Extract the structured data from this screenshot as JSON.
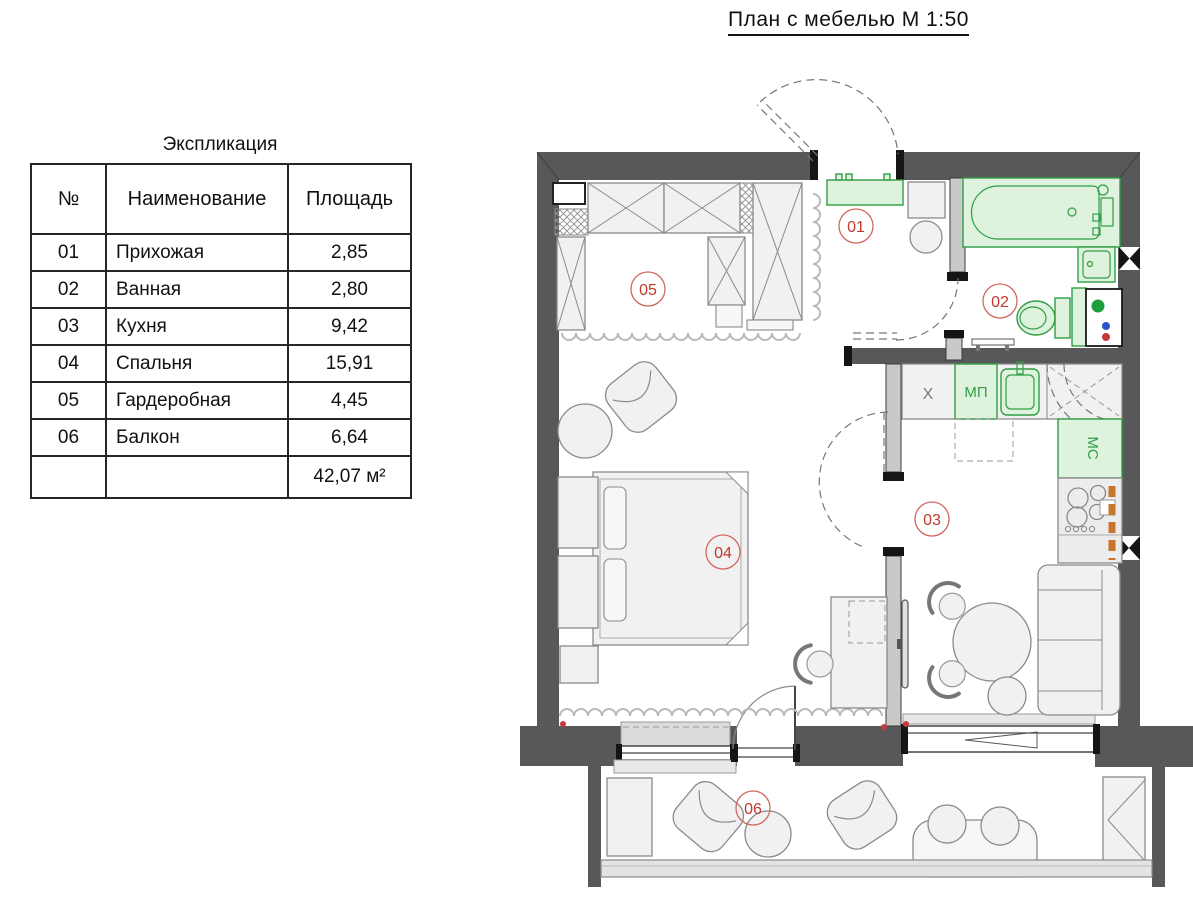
{
  "page_title": "План с мебелью М 1:50",
  "legend": {
    "title": "Экспликация",
    "columns": {
      "num": "№",
      "name": "Наименование",
      "area": "Площадь"
    },
    "rows": [
      {
        "num": "01",
        "name": "Прихожая",
        "area": "2,85"
      },
      {
        "num": "02",
        "name": "Ванная",
        "area": "2,80"
      },
      {
        "num": "03",
        "name": "Кухня",
        "area": "9,42"
      },
      {
        "num": "04",
        "name": "Спальня",
        "area": "15,91"
      },
      {
        "num": "05",
        "name": "Гардеробная",
        "area": "4,45"
      },
      {
        "num": "06",
        "name": "Балкон",
        "area": "6,64"
      }
    ],
    "total_area": "42,07 м²"
  },
  "plan": {
    "room_labels": [
      "01",
      "02",
      "03",
      "04",
      "05",
      "06"
    ],
    "appliance_labels": {
      "fridge": "Х",
      "dishwasher": "МП",
      "washing_machine": "МС"
    }
  },
  "colors": {
    "wall": "#58585a",
    "partition": "#c9c9c9",
    "fixture_green_fill": "#def2de",
    "fixture_green_stroke": "#2f9e44",
    "room_label_red": "#c0392b",
    "riser_orange": "#c8762c",
    "shaft_dot_green": "#1f9e3e",
    "shaft_dot_blue": "#2a52c9",
    "shaft_dot_red": "#c43a3a"
  }
}
